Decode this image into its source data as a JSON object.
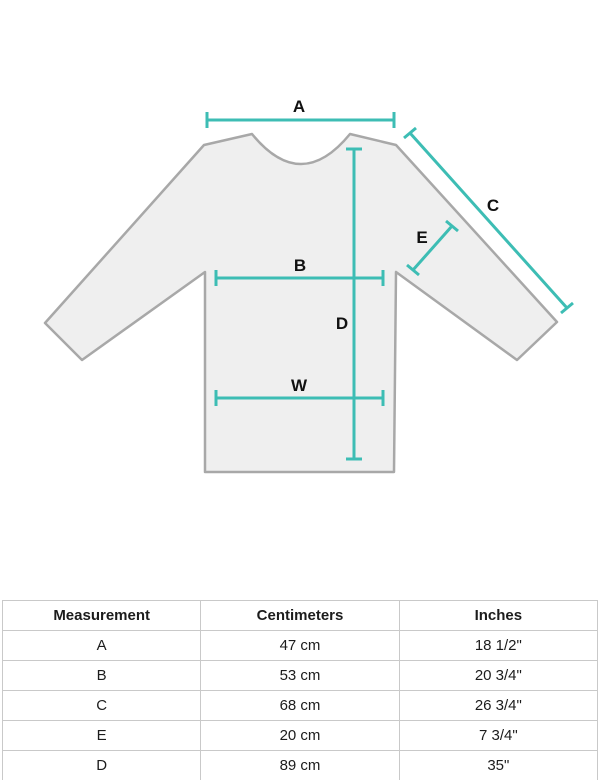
{
  "diagram": {
    "type": "garment-measurement-diagram",
    "garment": "long-sleeve top",
    "labels": {
      "a": "A",
      "b": "B",
      "c": "C",
      "d": "D",
      "e": "E",
      "w": "W"
    },
    "colors": {
      "measurement_line": "#3dbdb4",
      "garment_fill": "#efefef",
      "garment_outline": "#a8a8a8",
      "label_text": "#111111",
      "table_border": "#c9c9c9"
    }
  },
  "table": {
    "headers": [
      "Measurement",
      "Centimeters",
      "Inches"
    ],
    "rows": [
      {
        "measurement": "A",
        "centimeters": "47 cm",
        "inches": "18 1/2\""
      },
      {
        "measurement": "B",
        "centimeters": "53 cm",
        "inches": "20 3/4\""
      },
      {
        "measurement": "C",
        "centimeters": "68 cm",
        "inches": "26 3/4\""
      },
      {
        "measurement": "E",
        "centimeters": "20 cm",
        "inches": "7 3/4\""
      },
      {
        "measurement": "D",
        "centimeters": "89 cm",
        "inches": "35\""
      }
    ]
  }
}
